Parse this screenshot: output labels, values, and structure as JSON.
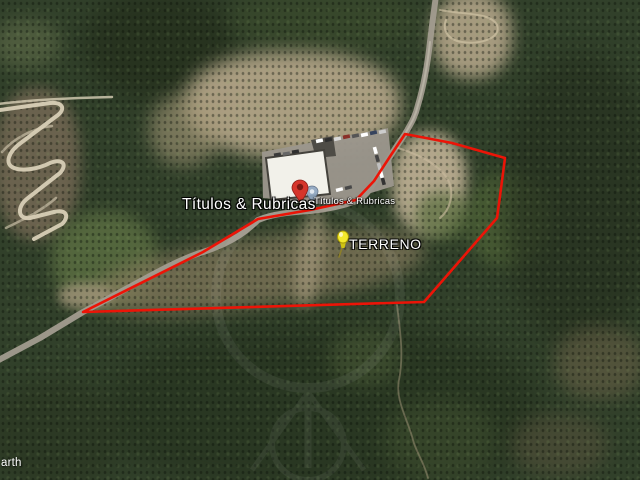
{
  "viewport": {
    "width": 640,
    "height": 480,
    "type": "satellite-imagery"
  },
  "overlays": {
    "business_label_large": "Títulos & Rubricas",
    "business_label_small": "Títulos & Rubricas",
    "parcel_label": "TERRENO",
    "earth_watermark_partial": "arth"
  },
  "parcel_outline": {
    "stroke_color": "#ec1407",
    "points": "83,312 203,252 258,219 310,210 356,200 374,181 391,155 405,134 452,143 505,158 500,196 497,218 424,302"
  },
  "markers": {
    "business_placemark": {
      "icon": "red-map-pin-icon",
      "color": "#d6352b"
    },
    "business_placemark_secondary": {
      "icon": "blue-balloon-icon",
      "color": "#8fa6c0"
    },
    "terreno_pushpin": {
      "icon": "yellow-pushpin-icon",
      "color": "#f4e92c"
    }
  }
}
